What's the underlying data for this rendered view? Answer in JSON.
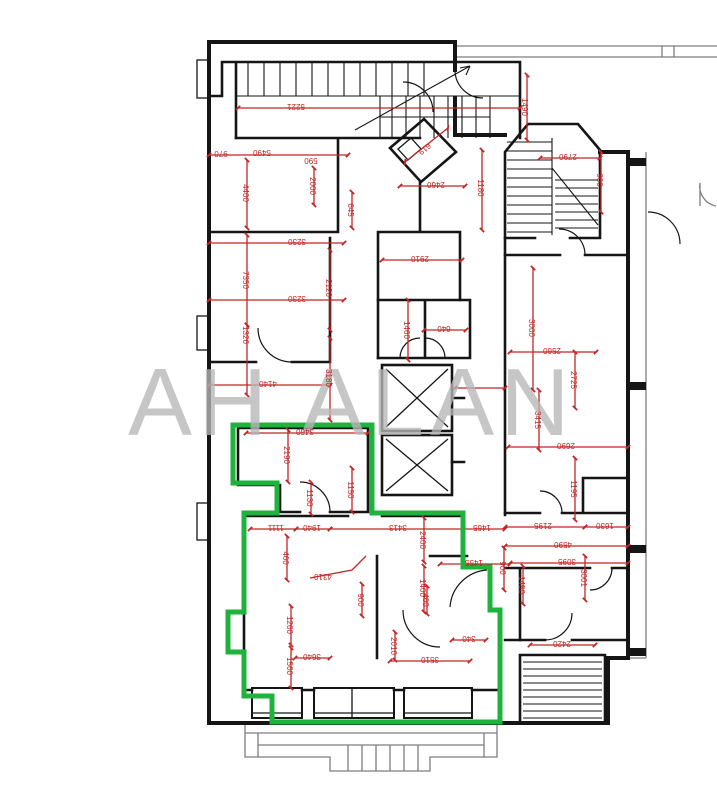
{
  "watermark": {
    "text": "AH ALAN"
  },
  "colors": {
    "wall": "#151515",
    "dim": "#c22525",
    "green": "#1eb33c",
    "watermark": "#b7b7b7",
    "annex": "#7e7e7e",
    "bg": "#ffffff"
  },
  "plan": {
    "kind": "architectural-floor-plan",
    "highlighted_unit": "green-outlined apartment, lower left",
    "annotation_color_note": "red dimension chains in mm, labels rotated"
  },
  "dimensions": [
    {
      "value": "5221",
      "x": 296,
      "y": 104,
      "rot": 180
    },
    {
      "value": "1490",
      "x": 522,
      "y": 107,
      "rot": 90
    },
    {
      "value": "970",
      "x": 221,
      "y": 151,
      "rot": 180
    },
    {
      "value": "5490",
      "x": 262,
      "y": 150,
      "rot": 180
    },
    {
      "value": "590",
      "x": 311,
      "y": 158,
      "rot": 180
    },
    {
      "value": "2460",
      "x": 436,
      "y": 182,
      "rot": 180
    },
    {
      "value": "619",
      "x": 423,
      "y": 147,
      "rot": 140
    },
    {
      "value": "1180",
      "x": 478,
      "y": 188,
      "rot": 90
    },
    {
      "value": "960",
      "x": 597,
      "y": 180,
      "rot": 90
    },
    {
      "value": "2790",
      "x": 568,
      "y": 154,
      "rot": 180
    },
    {
      "value": "4400",
      "x": 243,
      "y": 193,
      "rot": 90
    },
    {
      "value": "2000",
      "x": 310,
      "y": 186,
      "rot": 90
    },
    {
      "value": "645",
      "x": 348,
      "y": 210,
      "rot": 90
    },
    {
      "value": "3230",
      "x": 297,
      "y": 239,
      "rot": 180
    },
    {
      "value": "7350",
      "x": 243,
      "y": 280,
      "rot": 90
    },
    {
      "value": "1326",
      "x": 243,
      "y": 335,
      "rot": 90
    },
    {
      "value": "3230",
      "x": 297,
      "y": 296,
      "rot": 180
    },
    {
      "value": "2120",
      "x": 326,
      "y": 288,
      "rot": 90
    },
    {
      "value": "3180",
      "x": 326,
      "y": 378,
      "rot": 90
    },
    {
      "value": "4140",
      "x": 268,
      "y": 381,
      "rot": 180
    },
    {
      "value": "2910",
      "x": 420,
      "y": 256,
      "rot": 180
    },
    {
      "value": "640",
      "x": 444,
      "y": 326,
      "rot": 180
    },
    {
      "value": "1460",
      "x": 404,
      "y": 330,
      "rot": 90
    },
    {
      "value": "3000",
      "x": 529,
      "y": 328,
      "rot": 90
    },
    {
      "value": "2560",
      "x": 552,
      "y": 348,
      "rot": 180
    },
    {
      "value": "2725",
      "x": 571,
      "y": 380,
      "rot": 90
    },
    {
      "value": "3415",
      "x": 535,
      "y": 420,
      "rot": 90
    },
    {
      "value": "2690",
      "x": 566,
      "y": 443,
      "rot": 180
    },
    {
      "value": "1195",
      "x": 571,
      "y": 489,
      "rot": 90
    },
    {
      "value": "3460",
      "x": 305,
      "y": 429,
      "rot": 180
    },
    {
      "value": "2190",
      "x": 284,
      "y": 455,
      "rot": 90
    },
    {
      "value": "1130",
      "x": 307,
      "y": 498,
      "rot": 90
    },
    {
      "value": "1150",
      "x": 348,
      "y": 490,
      "rot": 90
    },
    {
      "value": "1111",
      "x": 276,
      "y": 525,
      "rot": 180
    },
    {
      "value": "1940",
      "x": 312,
      "y": 525,
      "rot": 180
    },
    {
      "value": "3413",
      "x": 398,
      "y": 525,
      "rot": 180
    },
    {
      "value": "1465",
      "x": 482,
      "y": 525,
      "rot": 180
    },
    {
      "value": "2195",
      "x": 543,
      "y": 523,
      "rot": 180
    },
    {
      "value": "1630",
      "x": 605,
      "y": 523,
      "rot": 180
    },
    {
      "value": "4590",
      "x": 563,
      "y": 542,
      "rot": 180
    },
    {
      "value": "1455",
      "x": 474,
      "y": 560,
      "rot": 180
    },
    {
      "value": "3095",
      "x": 567,
      "y": 559,
      "rot": 180
    },
    {
      "value": "2400",
      "x": 420,
      "y": 540,
      "rot": 90
    },
    {
      "value": "460",
      "x": 283,
      "y": 558,
      "rot": 90
    },
    {
      "value": "4310",
      "x": 323,
      "y": 574,
      "rot": 180
    },
    {
      "value": "1400",
      "x": 420,
      "y": 588,
      "rot": 90
    },
    {
      "value": "900",
      "x": 358,
      "y": 600,
      "rot": 90
    },
    {
      "value": "460",
      "x": 423,
      "y": 600,
      "rot": 90
    },
    {
      "value": "1450",
      "x": 519,
      "y": 585,
      "rot": 90
    },
    {
      "value": "900",
      "x": 500,
      "y": 568,
      "rot": 90
    },
    {
      "value": "3001",
      "x": 581,
      "y": 578,
      "rot": 90
    },
    {
      "value": "340",
      "x": 469,
      "y": 636,
      "rot": 180
    },
    {
      "value": "2010",
      "x": 391,
      "y": 646,
      "rot": 90
    },
    {
      "value": "3510",
      "x": 430,
      "y": 657,
      "rot": 180
    },
    {
      "value": "3640",
      "x": 312,
      "y": 654,
      "rot": 180
    },
    {
      "value": "1260",
      "x": 287,
      "y": 625,
      "rot": 90
    },
    {
      "value": "1560",
      "x": 287,
      "y": 666,
      "rot": 90
    },
    {
      "value": "2420",
      "x": 562,
      "y": 641,
      "rot": 180
    }
  ]
}
